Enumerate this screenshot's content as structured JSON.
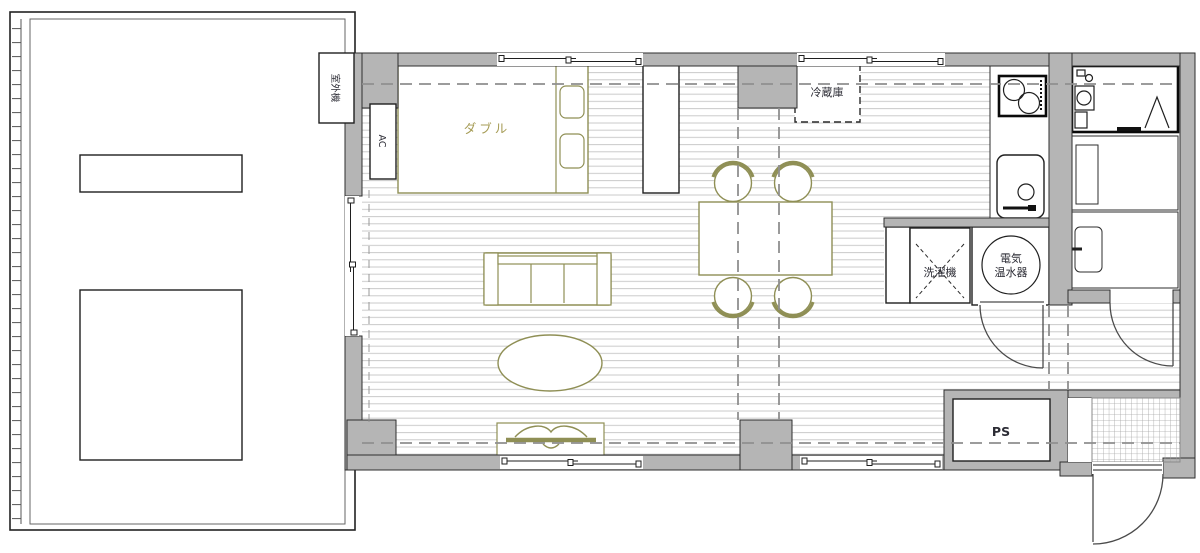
{
  "plan": {
    "title": "1LDK apartment floor plan",
    "labels": {
      "outdoor_unit": "室外機",
      "ac": "AC",
      "bed": "ダブル",
      "fridge": "冷蔵庫",
      "washer": "洗濯機",
      "water_heater_line1": "電気",
      "water_heater_line2": "温水器",
      "pipe_space": "PS"
    },
    "colors": {
      "wall": "#b5b5b5",
      "furniture": "#8f8f55",
      "bed_label": "#a59b54",
      "label_text": "#2c2c35",
      "dash": "#8f8f8f",
      "floor_line": "#c8c8c8",
      "deck_line": "#b2b2b2"
    }
  }
}
